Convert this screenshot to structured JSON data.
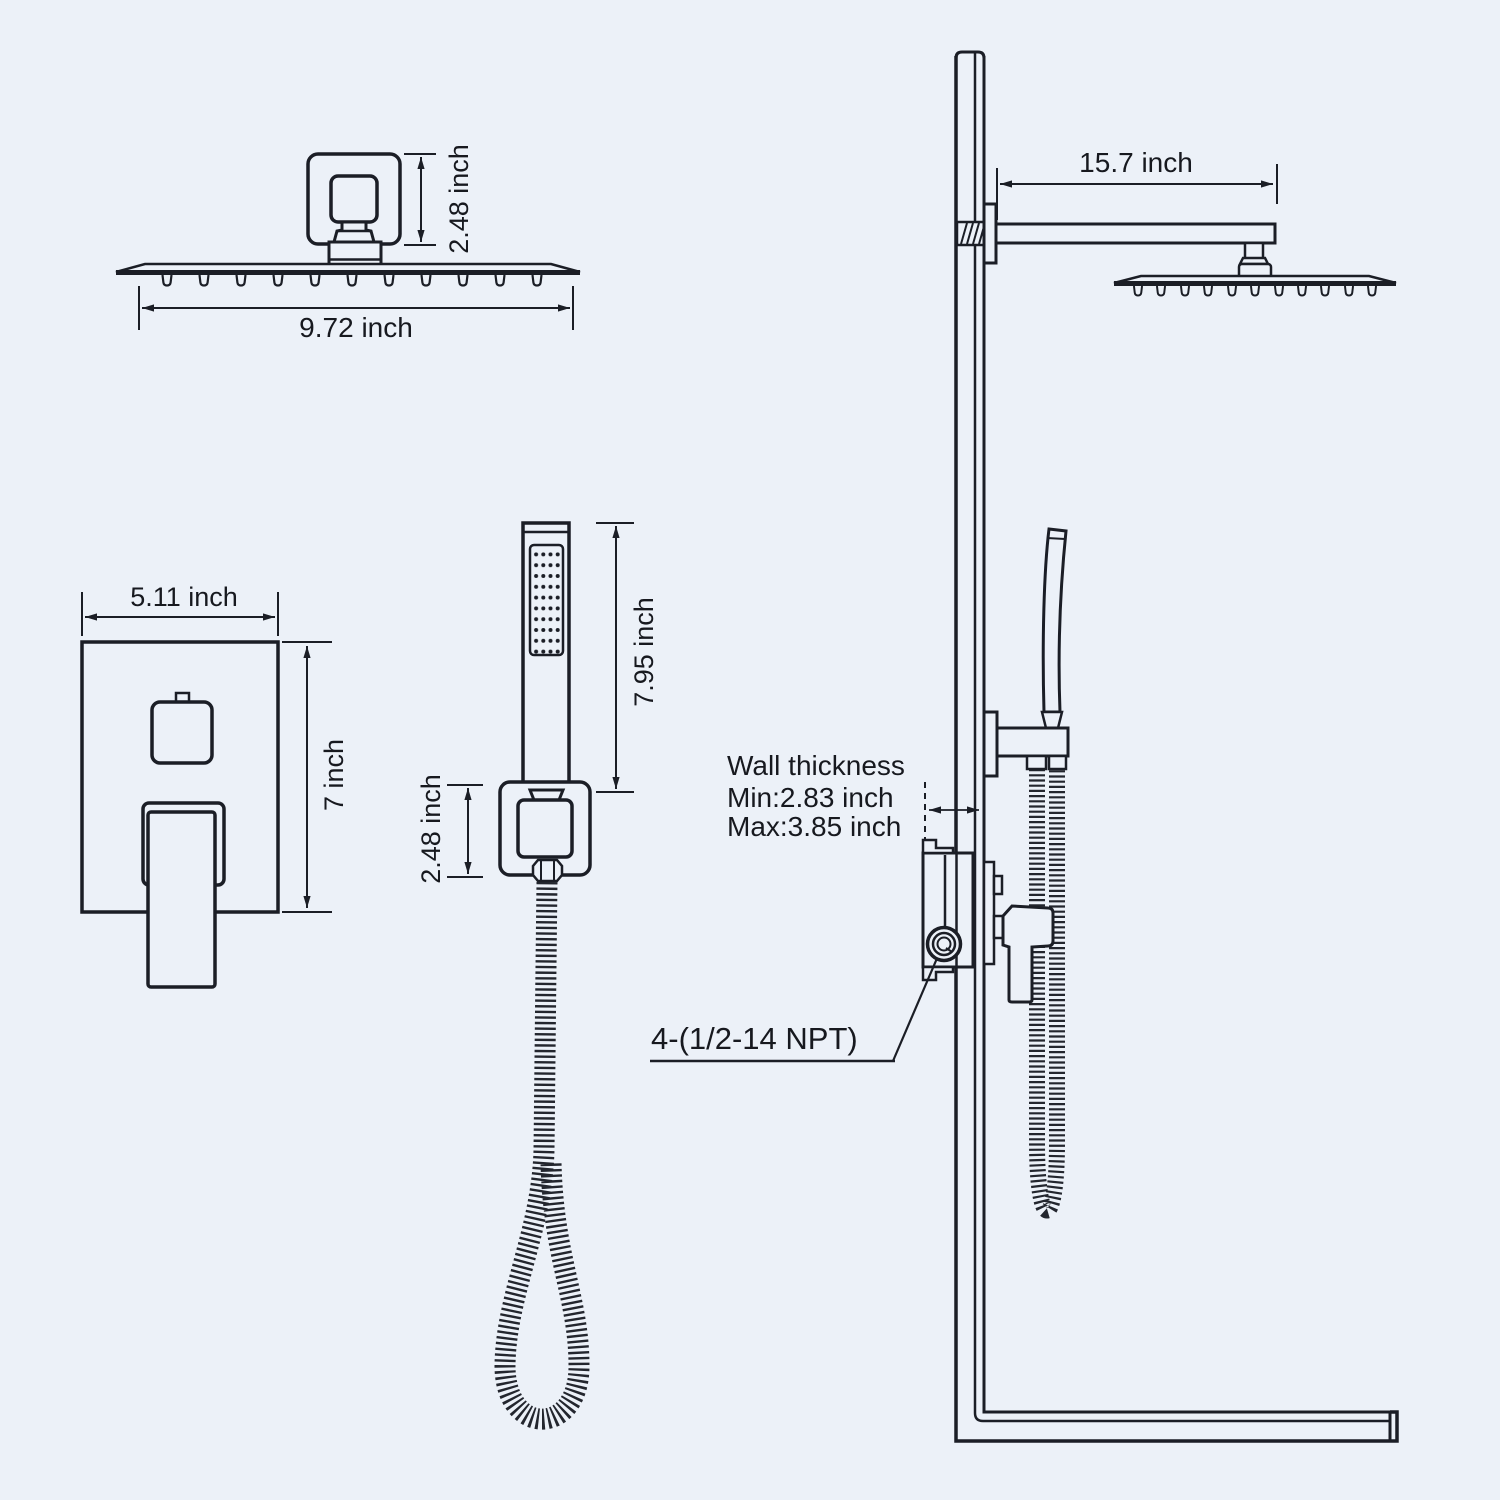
{
  "page": {
    "background_color": "#ecf1f8",
    "line_color": "#1b1e26"
  },
  "views": {
    "rain_head_front": {
      "title": "rain-shower-head-front-view",
      "width_label": "9.72 inch",
      "height_label": "2.48 inch"
    },
    "valve_front": {
      "title": "valve-trim-front-view",
      "width_label": "5.11 inch",
      "height_label": "7 inch"
    },
    "handheld_front": {
      "title": "handheld-shower-front-view",
      "length_label": "7.95 inch",
      "holder_label": "2.48 inch"
    },
    "assembly_side": {
      "title": "installed-system-side-view",
      "arm_length_label": "15.7 inch",
      "wall_thickness_title": "Wall thickness",
      "wall_thickness_min": "Min:2.83 inch",
      "wall_thickness_max": "Max:3.85 inch",
      "connection_label": "4-(1/2-14 NPT)"
    }
  }
}
